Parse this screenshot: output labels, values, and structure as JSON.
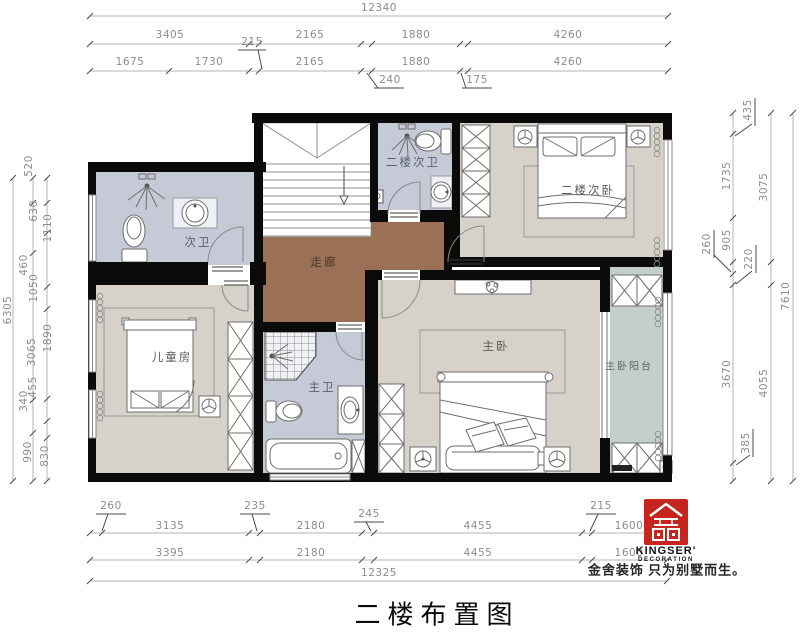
{
  "title": "二楼布置图",
  "brand": {
    "name": "KINGSER'",
    "sub": "DECORATION",
    "tagline": "金舍装饰 只为别墅而生。",
    "logo_color": "#c5251c"
  },
  "rooms": {
    "ciwei": "次卫",
    "erlou_ciwei": "二楼次卫",
    "erlou_ciwo": "二楼次卧",
    "zoulang": "走廊",
    "ertongfang": "儿童房",
    "zhuwei": "主卫",
    "zhuwo": "主卧",
    "zhuwo_yangtai": "主卧阳台"
  },
  "dims": {
    "top": {
      "total": "12340",
      "row2": [
        "3405",
        "2165",
        "1880",
        "4260"
      ],
      "row2_leader": "215",
      "row3": [
        "1675",
        "1730",
        "2165",
        "1880",
        "4260"
      ],
      "leader_240": "240",
      "leader_175": "175"
    },
    "bottom": {
      "leaders": [
        "260",
        "235",
        "245",
        "215"
      ],
      "row1": [
        "3135",
        "2180",
        "4455",
        "1600"
      ],
      "row2": [
        "3395",
        "2180",
        "4455",
        "1600"
      ],
      "total": "12325"
    },
    "left": {
      "labels": [
        "520",
        "630",
        "1110",
        "460",
        "1050",
        "1890",
        "3065",
        "455",
        "340",
        "990",
        "830"
      ],
      "total": "6305"
    },
    "right": {
      "chain": [
        "435",
        "1735",
        "905",
        "260",
        "220",
        "3670",
        "385"
      ],
      "middle": [
        "3075",
        "4055"
      ],
      "total": "7610"
    }
  },
  "colors": {
    "wall": "#0b0b0b",
    "bath_floor": "#c6cad7",
    "bedroom_floor": "#d6d2ca",
    "corridor_floor": "#9a7156",
    "balcony_floor": "#c4cfc9"
  }
}
